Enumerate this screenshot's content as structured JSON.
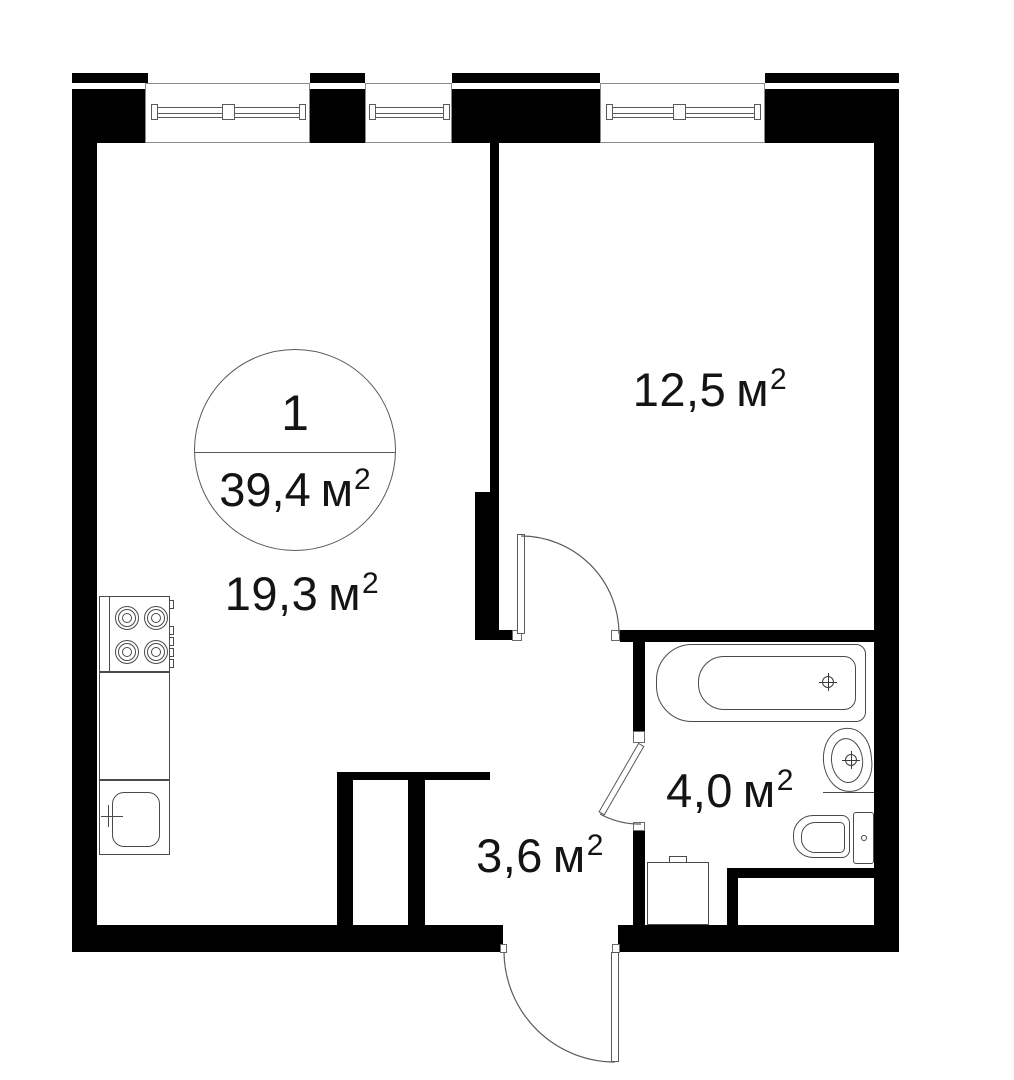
{
  "floorplan": {
    "unit_circle": {
      "number": "1",
      "area_value": "39,4",
      "area_unit": "м",
      "area_power": "2"
    },
    "rooms": {
      "living": {
        "value": "19,3",
        "unit": "м",
        "power": "2"
      },
      "bedroom": {
        "value": "12,5",
        "unit": "м",
        "power": "2"
      },
      "bathroom": {
        "value": "4,0",
        "unit": "м",
        "power": "2"
      },
      "hall": {
        "value": "3,6",
        "unit": "м",
        "power": "2"
      }
    },
    "colors": {
      "wall": "#000000",
      "outline": "#4a4a4a",
      "text": "#141414",
      "background": "#ffffff"
    }
  }
}
